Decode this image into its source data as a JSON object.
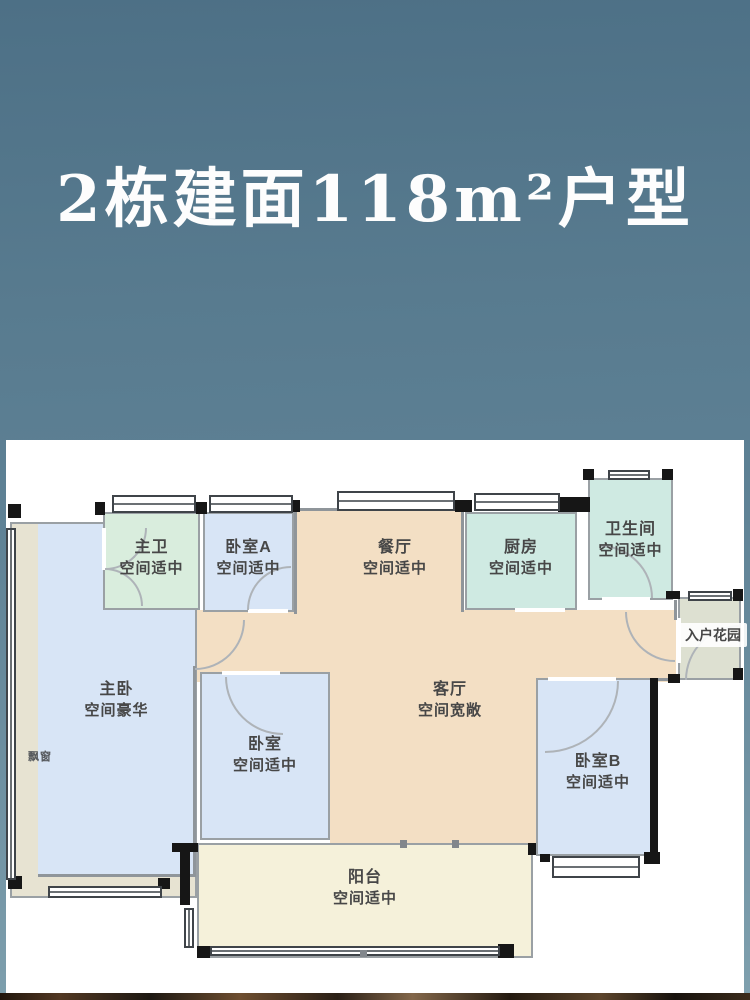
{
  "title": "2栋建面118m²户型",
  "plan": {
    "rooms": {
      "master_bath": {
        "name": "主卫",
        "desc": "空间适中"
      },
      "bedroom_a": {
        "name": "卧室A",
        "desc": "空间适中"
      },
      "dining": {
        "name": "餐厅",
        "desc": "空间适中"
      },
      "kitchen": {
        "name": "厨房",
        "desc": "空间适中"
      },
      "bathroom": {
        "name": "卫生间",
        "desc": "空间适中"
      },
      "entry_garden": {
        "name": "入户花园"
      },
      "master_bedroom": {
        "name": "主卧",
        "desc": "空间豪华"
      },
      "bay_window": {
        "name": "飘窗"
      },
      "bedroom_center": {
        "name": "卧室",
        "desc": "空间适中"
      },
      "living": {
        "name": "客厅",
        "desc": "空间宽敞"
      },
      "bedroom_b": {
        "name": "卧室B",
        "desc": "空间适中"
      },
      "balcony": {
        "name": "阳台",
        "desc": "空间适中"
      }
    }
  },
  "colors": {
    "background_top": "#4d7086",
    "background_bottom": "#7fa0ae",
    "title_text": "#fdfdfd",
    "panel": "#ffffff",
    "room_blue": "#d8e5f6",
    "room_green": "#d9eddd",
    "room_teal": "#cfeae2",
    "room_tan": "#f3dfc4",
    "room_cream": "#f5f1da",
    "room_garden_gray_green": "#dde0d1",
    "bay_window_band": "#e7e3d2",
    "wall_gray": "#8f959a",
    "wall_black": "#161616",
    "label_text": "#474747",
    "photo_strip_dark": "#2a1f16"
  }
}
